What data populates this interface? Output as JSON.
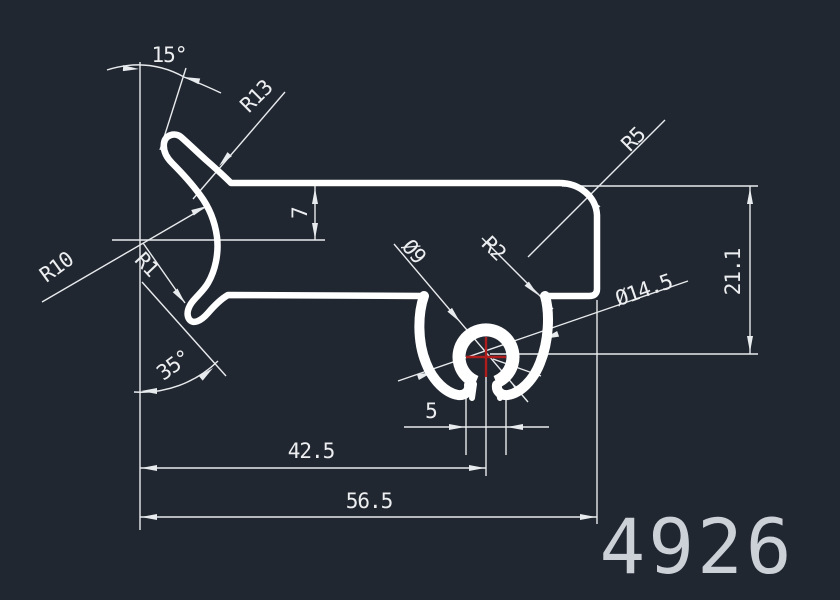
{
  "part_number": "4926",
  "colors": {
    "background": "#212731",
    "geometry": "#ffffff",
    "dimension": "#e8ebed",
    "dimension_text": "#eceef0",
    "part_number_text": "#ccd1d7",
    "center_mark": "#b01d1d"
  },
  "dimensions": {
    "angle_top": "15°",
    "radius_neck": "R13",
    "radius_arc": "R10",
    "radius_hook": "R1",
    "wall_offset": "7",
    "radius_corner": "R5",
    "diameter_boss": "Ø9",
    "radius_prong": "R2",
    "diameter_claw": "Ø14.5",
    "height_right": "21.1",
    "angle_bottom": "35°",
    "slot_width": "5",
    "length_to_center": "42.5",
    "length_total": "56.5"
  }
}
